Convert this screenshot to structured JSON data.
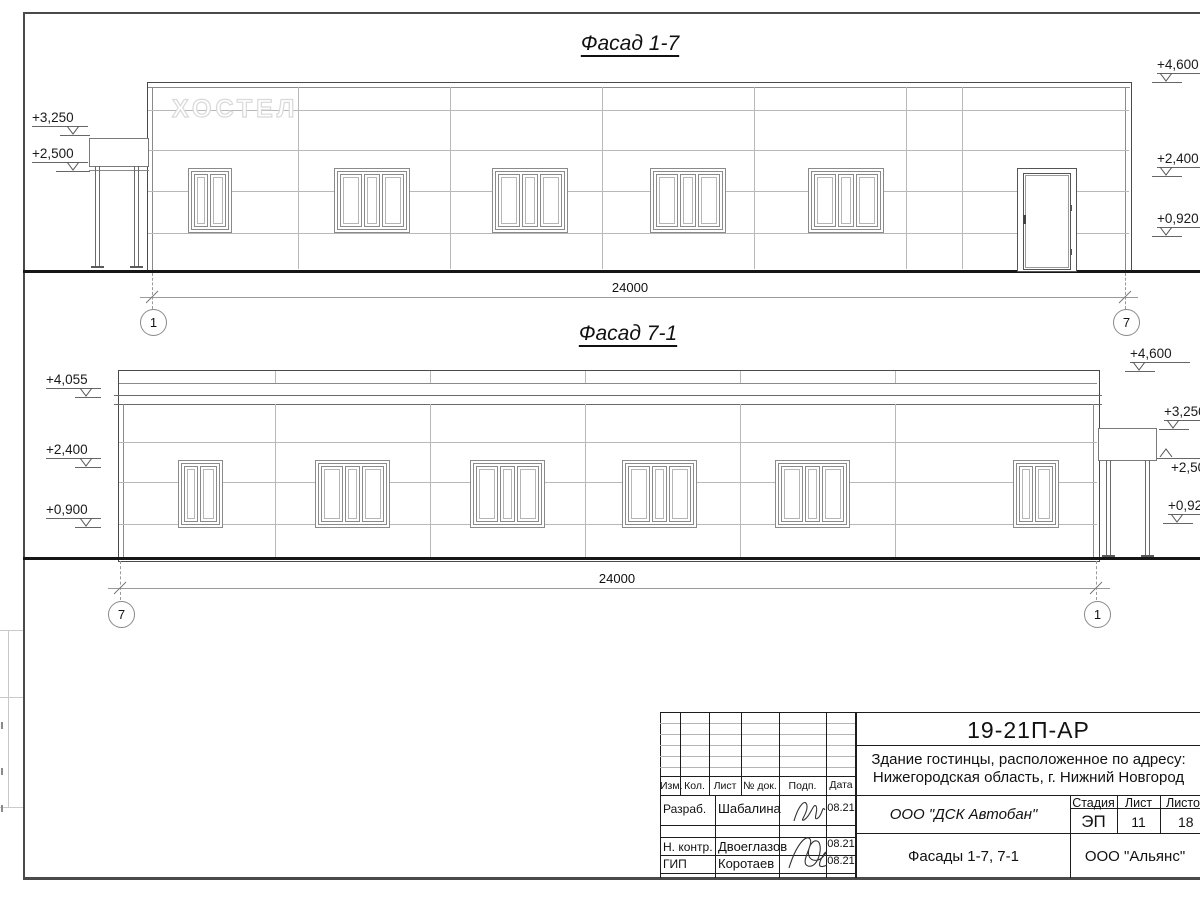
{
  "facade_17": {
    "title": "Фасад 1-7",
    "sign": "ХОСТЕЛ",
    "marks_left": [
      {
        "v": "+3,250"
      },
      {
        "v": "+2,500"
      }
    ],
    "marks_right": [
      {
        "v": "+4,600"
      },
      {
        "v": "+2,400"
      },
      {
        "v": "+0,920"
      }
    ],
    "dim": "24000",
    "axis_start": "1",
    "axis_end": "7"
  },
  "facade_71": {
    "title": "Фасад 7-1",
    "marks_left": [
      {
        "v": "+4,055"
      },
      {
        "v": "+2,400"
      },
      {
        "v": "+0,900"
      }
    ],
    "marks_right": [
      {
        "v": "+4,600"
      },
      {
        "v": "+3,250"
      },
      {
        "v": "+2,500"
      },
      {
        "v": "+0,920"
      }
    ],
    "dim": "24000",
    "axis_start": "7",
    "axis_end": "1"
  },
  "title_block": {
    "doc_number": "19-21П-АР",
    "project_address_line1": "Здание гостинцы, расположенное по адресу:",
    "project_address_line2": "Нижегородская область, г. Нижний Новгород",
    "columns": [
      "Изм.",
      "Кол.",
      "Лист",
      "№ док.",
      "Подп.",
      "Дата"
    ],
    "staff": [
      {
        "role": "Разраб.",
        "name": "Шабалина",
        "date": "08.21"
      },
      {
        "role": "Н. контр.",
        "name": "Двоеглазов",
        "date": "08.21"
      },
      {
        "role": "ГИП",
        "name": "Коротаев",
        "date": "08.21"
      }
    ],
    "contractor": "ООО \"ДСК Автобан\"",
    "stage_label": "Стадия",
    "sheet_label": "Лист",
    "sheets_label": "Листов",
    "stage": "ЭП",
    "sheet": "11",
    "sheets": "18",
    "sheet_name": "Фасады 1-7, 7-1",
    "organization": "ООО \"Альянс\""
  }
}
